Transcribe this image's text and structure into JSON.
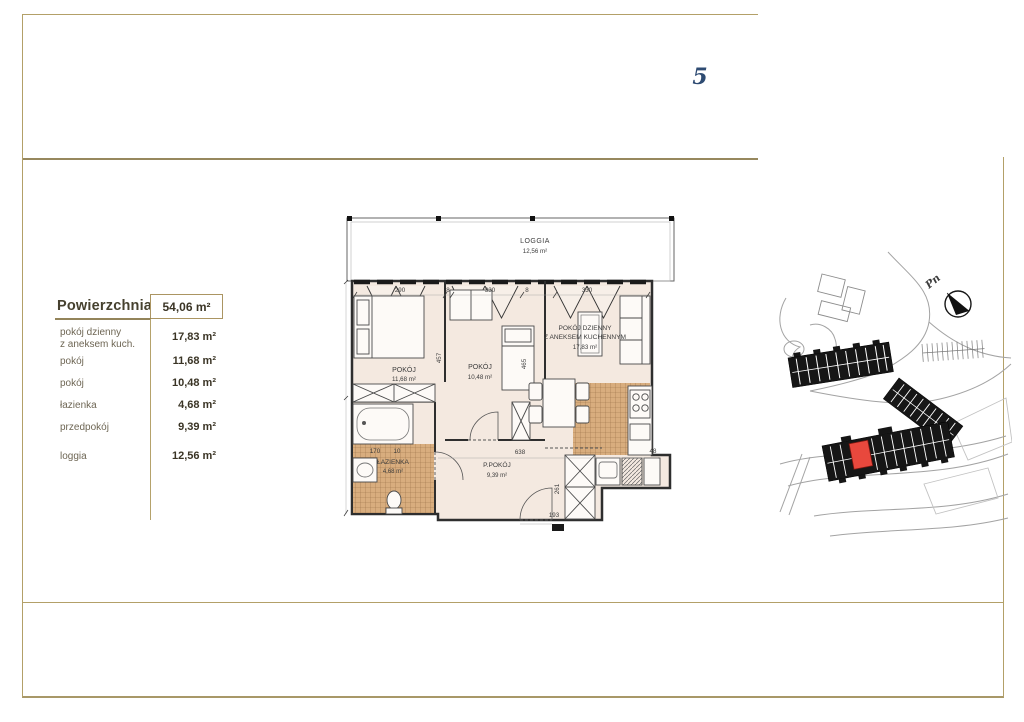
{
  "page": {
    "unit_number": "5"
  },
  "area_table": {
    "title": "Powierzchnia",
    "total": "54,06 m²",
    "rows": [
      {
        "label1": "pokój dzienny",
        "label2": "z aneksem kuch.",
        "value": "17,83 m²"
      },
      {
        "label1": "pokój",
        "value": "11,68 m²"
      },
      {
        "label1": "pokój",
        "value": "10,48 m²"
      },
      {
        "label1": "łazienka",
        "value": "4,68 m²"
      },
      {
        "label1": "przedpokój",
        "value": "9,39 m²"
      },
      {
        "label1": "loggia",
        "value": "12,56 m²"
      }
    ]
  },
  "floor_plan": {
    "loggia": {
      "name": "LOGGIA",
      "area": "12,56 m²"
    },
    "room_left": {
      "name": "POKÓJ",
      "area": "11,68 m²"
    },
    "room_mid": {
      "name": "POKÓJ",
      "area": "10,48 m²"
    },
    "living": {
      "name1": "POKÓJ DZIENNY",
      "name2": "Z ANEKSEM KUCHENNYM",
      "area": "17,83 m²"
    },
    "bathroom": {
      "name": "ŁAZIENKA",
      "area": "4,68 m²"
    },
    "hall": {
      "name": "P.POKÓJ",
      "area": "9,39 m²"
    },
    "dims": {
      "top1": "290",
      "top2": "8",
      "top3": "330",
      "top4": "8",
      "top5": "330",
      "left_room_h": "457",
      "mid_room_h": "465",
      "hall_w": "638",
      "hall_h": "261",
      "entry": "193",
      "bath_w": "170",
      "bath_gap": "10",
      "shaft": "48"
    }
  },
  "site_plan": {
    "north_label": "Pn"
  },
  "colors": {
    "gold": "#ac9663",
    "navy": "#2e4b72",
    "accent_red": "#e8483d",
    "plan_beige": "#f4e9e0"
  }
}
